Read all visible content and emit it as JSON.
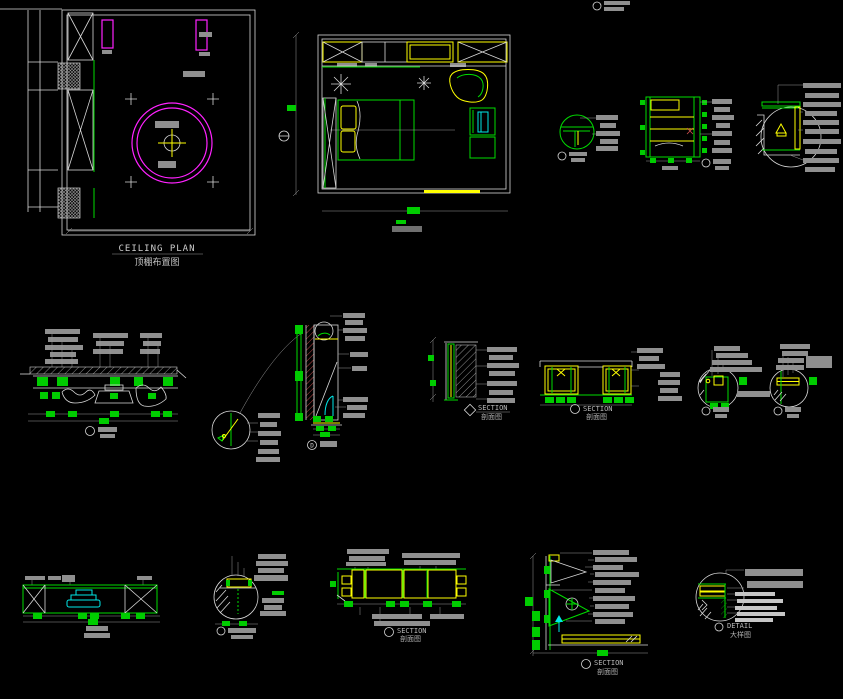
{
  "drawing": {
    "background": "#000000",
    "palette": {
      "line_white": "#d8d8d8",
      "green": "#00dd00",
      "yellow": "#ffff00",
      "magenta": "#ff22ff",
      "cyan": "#00e8e8",
      "red_hatch": "#d05050",
      "label_gray": "#8f8f8f",
      "text_gray": "#c0c0c0"
    },
    "titles": {
      "ceiling_en": "CEILING PLAN",
      "ceiling_cn": "顶棚布置图",
      "section_en": "SECTION",
      "section_cn": "剖面图",
      "detail_en": "DETAIL",
      "detail_cn": "大样图"
    },
    "callouts": {
      "d": "D"
    }
  }
}
